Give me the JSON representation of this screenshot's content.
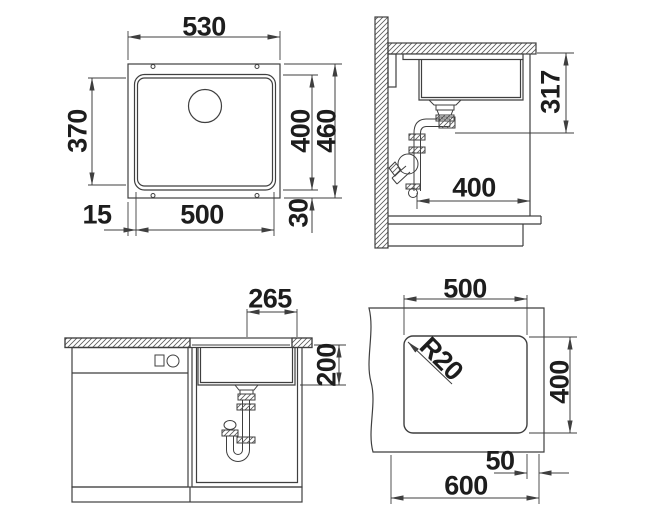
{
  "drawing_title": "sink-installation-drawing",
  "colors": {
    "background": "#ffffff",
    "line": "#3f3f3f",
    "text": "#1d1d1d"
  },
  "dims": {
    "top": {
      "outer_width": "530",
      "inner_depth": "370",
      "inner_height": "400",
      "outer_height": "460",
      "rim_left": "15",
      "inner_width": "500",
      "rim_bottom": "30"
    },
    "side": {
      "drain_height": "317",
      "depth": "400"
    },
    "front": {
      "drain_offset": "265",
      "bowl_depth": "200"
    },
    "cutout": {
      "width": "500",
      "corner_radius": "R20",
      "height": "400",
      "edge_offset": "50",
      "counter_width": "600"
    }
  }
}
